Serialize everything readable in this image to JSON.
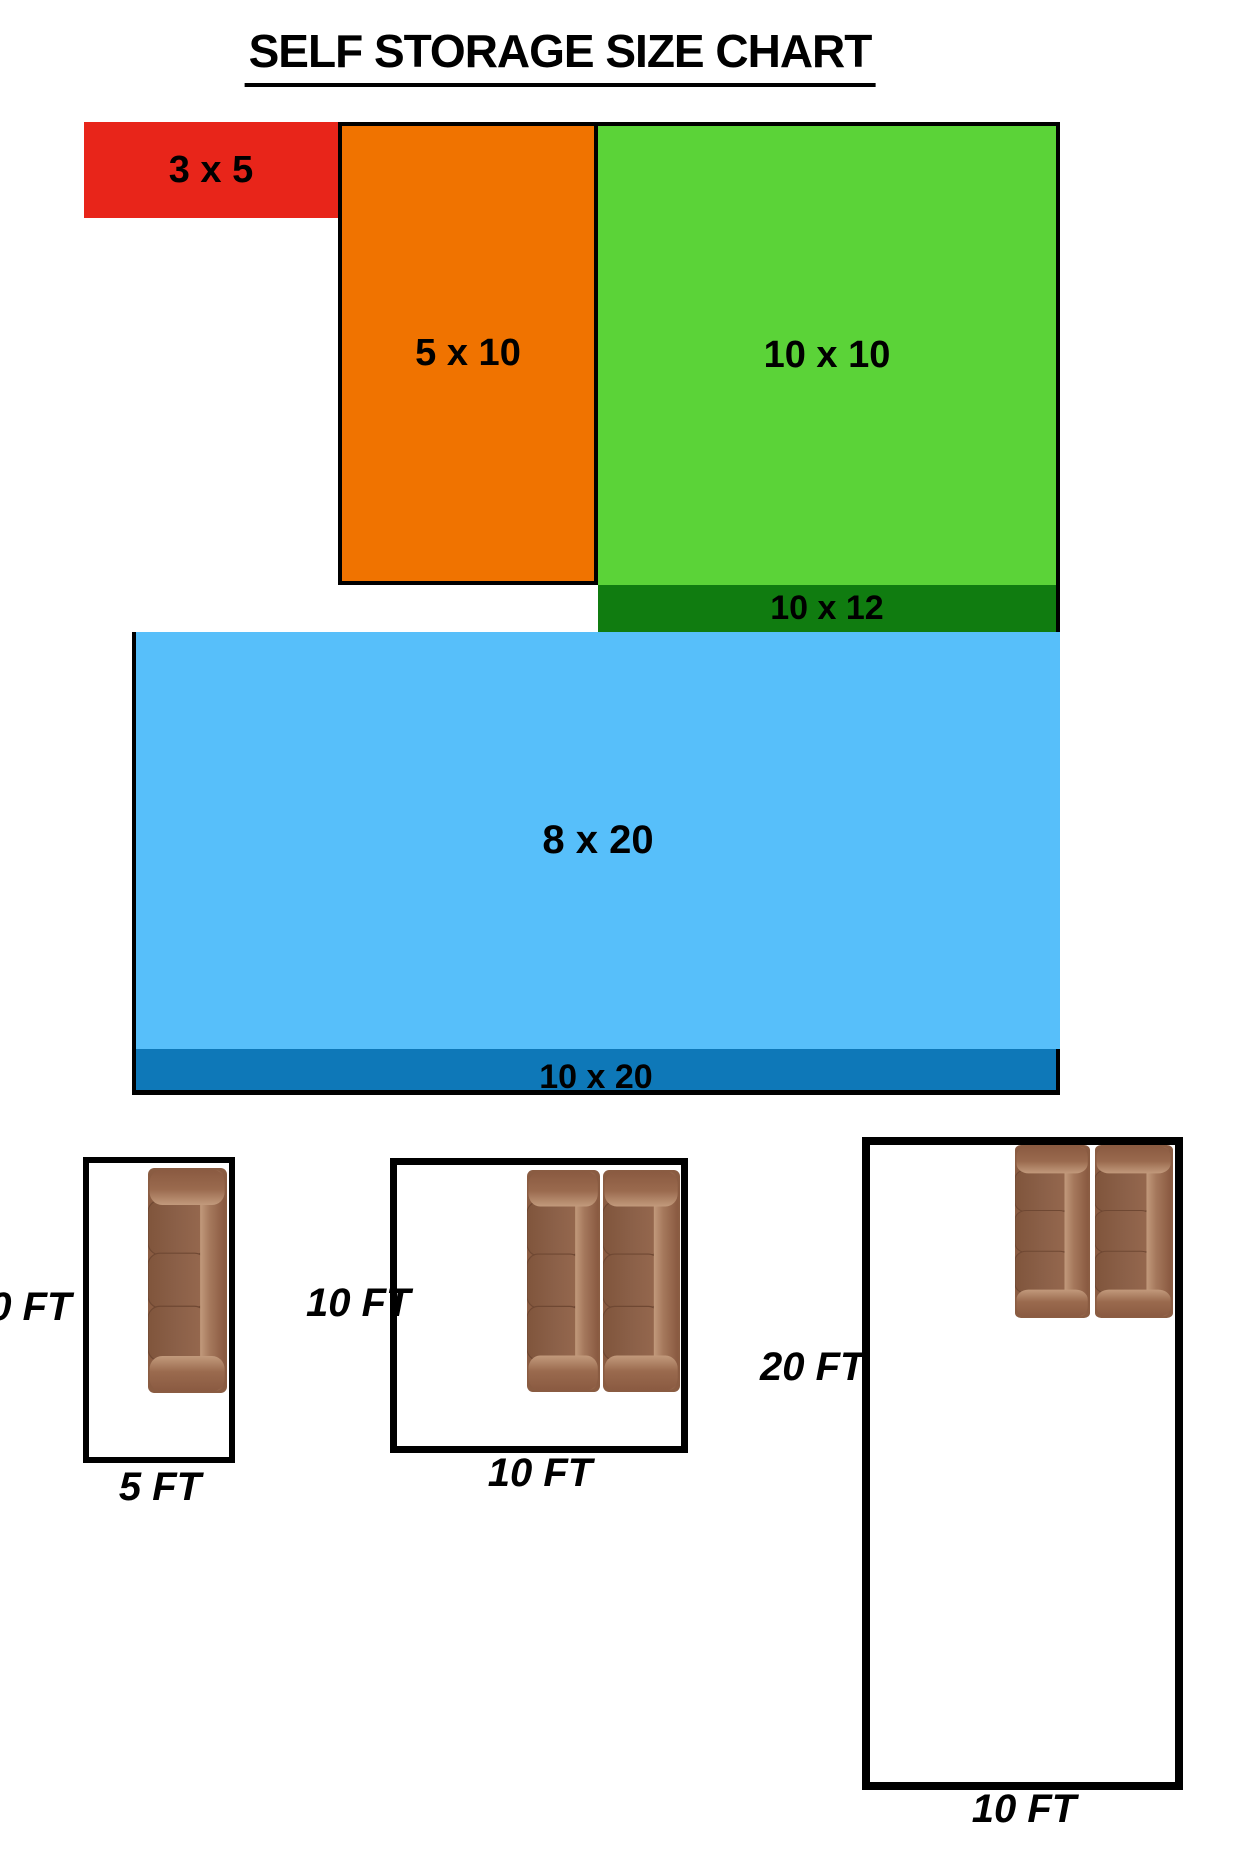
{
  "title": "SELF STORAGE SIZE CHART",
  "units": [
    {
      "name": "3x5",
      "label": "3 x 5",
      "color": "#e8251a"
    },
    {
      "name": "5x10",
      "label": "5 x 10",
      "color": "#f07300"
    },
    {
      "name": "10x10",
      "label": "10 x 10",
      "color": "#5bd338"
    },
    {
      "name": "10x12",
      "label": "10 x 12",
      "color": "#107c10"
    },
    {
      "name": "8x20",
      "label": "8 x 20",
      "color": "#57bffa"
    },
    {
      "name": "10x20",
      "label": "10 x 20",
      "color": "#0e78b8"
    }
  ],
  "rooms": [
    {
      "name": "room-5x10",
      "width_label": "5 FT",
      "height_label": "10 FT",
      "couch_count": 1
    },
    {
      "name": "room-10x10",
      "width_label": "10 FT",
      "height_label": "10 FT",
      "couch_count": 2
    },
    {
      "name": "room-10x20",
      "width_label": "10 FT",
      "height_label": "20 FT",
      "couch_count": 2
    }
  ],
  "couch_colors": {
    "frame": "#8a5c42",
    "cushion": "#8b6048",
    "highlight": "#c29a7c"
  }
}
